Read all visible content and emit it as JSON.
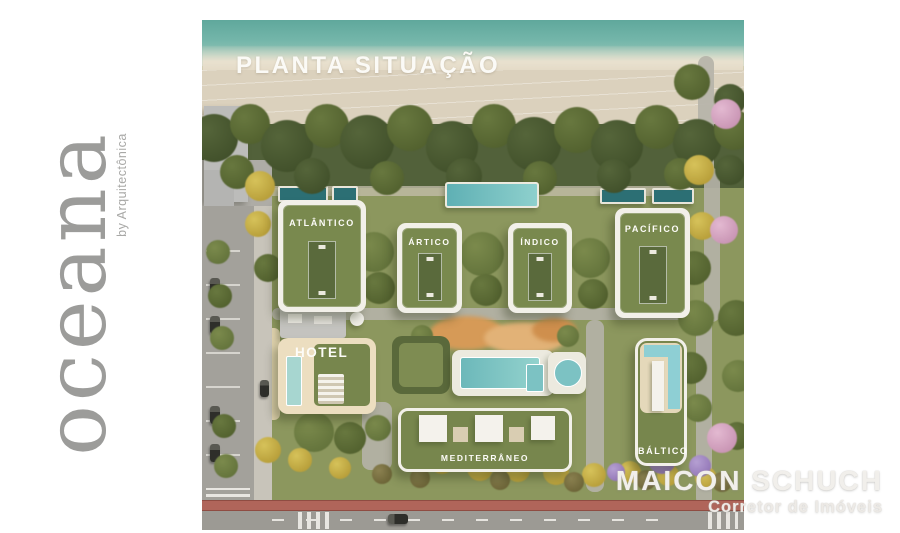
{
  "logo": {
    "brand": "oceana",
    "byline": "by Arquitectônica"
  },
  "plan": {
    "title": "PLANTA SITUAÇÃO",
    "buildings": {
      "atlantico": "ATLÂNTICO",
      "artico": "ÁRTICO",
      "indico": "ÍNDICO",
      "pacifico": "PACÍFICO",
      "hotel": "HOTEL",
      "mediterraneo": "MEDITERRÂNEO",
      "baltico": "BÁLTICO"
    }
  },
  "watermark": {
    "name": "MAICON SCHUCH",
    "subtitle": "Corretor de Imóveis"
  },
  "colors": {
    "brand_gray": "#9c9c9a",
    "water_teal": "#74b6aa",
    "sand": "#dbd1bd",
    "vegetation": "#52613a",
    "roof_green": "#79894e",
    "pool_teal": "#7fc4c4",
    "bike_lane_red": "#b0655a",
    "label_white": "#fbfaf6",
    "watermark_gray": "#dddbd7"
  }
}
